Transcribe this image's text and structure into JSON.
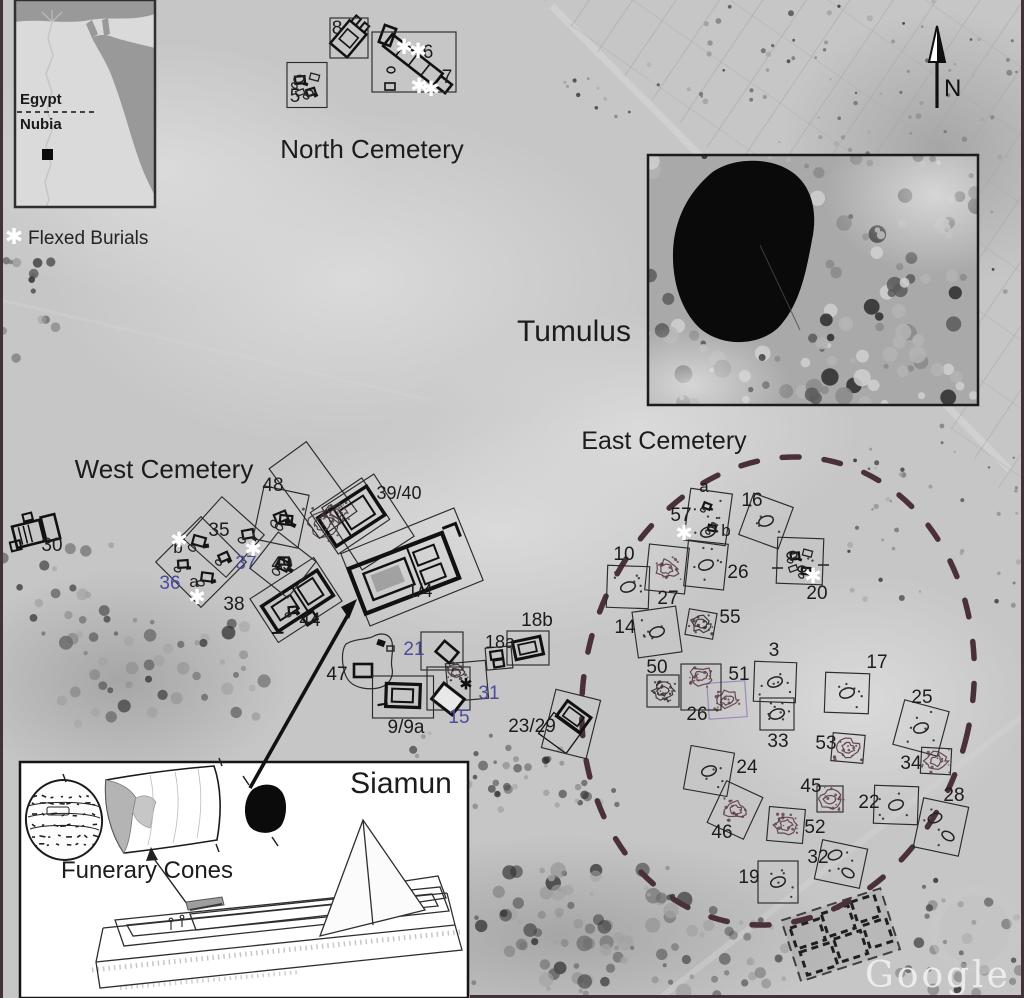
{
  "figure": {
    "legend": {
      "asterisk": "✱",
      "label": "Flexed Burials"
    },
    "inset_map": {
      "egypt": "Egypt",
      "nubia": "Nubia"
    },
    "compass": {
      "label": "N"
    },
    "titles": {
      "north_cemetery": "North Cemetery",
      "west_cemetery": "West Cemetery",
      "east_cemetery": "East Cemetery",
      "tumulus": "Tumulus"
    },
    "siamun": {
      "title": "Siamun",
      "caption": "Funerary Cones"
    },
    "watermark": "Google"
  },
  "colors": {
    "blue_label": "#4b4b9d",
    "maroon_dash": "#4a3038",
    "maroon_draw": "#5b3a47",
    "purple_box": "#9c86bb",
    "ink": "#1c1c1c",
    "white": "#ffffff"
  },
  "map_data": {
    "tombs": [
      {
        "label": "8",
        "lx": 337,
        "ly": 34,
        "box": [
          349,
          38,
          38,
          40,
          0
        ]
      },
      {
        "label": "5",
        "lx": 295,
        "ly": 102,
        "box": [
          307,
          85,
          40,
          45,
          0
        ],
        "glyph": "pebbles"
      },
      {
        "label": "6",
        "lx": 428,
        "ly": 58,
        "box": [
          414,
          62,
          84,
          60,
          0
        ]
      },
      {
        "label": "7",
        "lx": 447,
        "ly": 83
      },
      {
        "label": "30",
        "lx": 52,
        "ly": 551
      },
      {
        "label": "48",
        "lx": 273,
        "ly": 491,
        "box": [
          281,
          517,
          46,
          54,
          12
        ],
        "glyph": "cluster"
      },
      {
        "label": "35",
        "lx": 219,
        "ly": 536,
        "box": [
          224,
          537,
          57,
          57,
          42
        ]
      },
      {
        "label": "b",
        "lx": 178,
        "ly": 553,
        "fs": 17,
        "box": [
          201,
          562,
          64,
          64,
          45
        ]
      },
      {
        "label": "37",
        "lx": 246,
        "ly": 569,
        "color": "blue"
      },
      {
        "label": "49",
        "lx": 282,
        "ly": 570,
        "box": [
          283,
          565,
          48,
          46,
          38
        ],
        "glyph": "cluster"
      },
      {
        "label": "36",
        "lx": 170,
        "ly": 589,
        "color": "blue"
      },
      {
        "label": "a",
        "lx": 194,
        "ly": 587,
        "fs": 17
      },
      {
        "label": "38",
        "lx": 234,
        "ly": 610
      },
      {
        "label": "44",
        "lx": 310,
        "ly": 626
      },
      {
        "label": "39/40",
        "lx": 399,
        "ly": 499,
        "fs": 18
      },
      {
        "label": "1/4",
        "lx": 420,
        "ly": 597,
        "fs": 18
      },
      {
        "label": "47",
        "lx": 337,
        "ly": 680
      },
      {
        "label": "21",
        "lx": 414,
        "ly": 655,
        "color": "blue",
        "box": [
          442,
          651,
          42,
          38,
          0
        ]
      },
      {
        "label": "31",
        "lx": 489,
        "ly": 699,
        "color": "blue"
      },
      {
        "label": "15",
        "lx": 459,
        "ly": 723,
        "color": "blue"
      },
      {
        "label": "9/9a",
        "lx": 406,
        "ly": 733,
        "box": [
          403,
          697,
          61,
          42,
          0
        ]
      },
      {
        "label": "18a",
        "lx": 500,
        "ly": 648,
        "fs": 18,
        "box": [
          499,
          658,
          26,
          22,
          -5
        ]
      },
      {
        "label": "18b",
        "lx": 537,
        "ly": 626,
        "box": [
          528,
          648,
          42,
          34,
          0
        ]
      },
      {
        "label": "23/29",
        "lx": 532,
        "ly": 732,
        "box": [
          571,
          724,
          46,
          60,
          14
        ]
      },
      {
        "label": "a",
        "lx": 704,
        "ly": 492,
        "fs": 17
      },
      {
        "label": "57",
        "lx": 681,
        "ly": 521,
        "box": [
          708,
          517,
          42,
          52,
          8
        ],
        "glyph": "oval",
        "gy": 532,
        "dots": 12
      },
      {
        "label": "b",
        "lx": 726,
        "ly": 536,
        "fs": 17
      },
      {
        "label": "16",
        "lx": 752,
        "ly": 506,
        "box": [
          766,
          521,
          42,
          44,
          20
        ],
        "glyph": "oval",
        "dots": 5
      },
      {
        "label": "10",
        "lx": 624,
        "ly": 560,
        "box": [
          628,
          587,
          42,
          42,
          2
        ],
        "glyph": "oval",
        "dots": 7
      },
      {
        "label": "26",
        "lx": 738,
        "ly": 578,
        "box": [
          706,
          565,
          40,
          46,
          6
        ],
        "glyph": "oval",
        "dots": 6
      },
      {
        "label": "",
        "box": [
          667,
          569,
          40,
          46,
          6
        ],
        "glyph": "scribble"
      },
      {
        "label": "27",
        "lx": 668,
        "ly": 604
      },
      {
        "label": "20",
        "lx": 817,
        "ly": 599,
        "box": [
          800,
          561,
          46,
          46,
          2
        ],
        "glyph": "pebbles",
        "dots": 4
      },
      {
        "label": "14",
        "lx": 625,
        "ly": 633,
        "box": [
          657,
          632,
          44,
          46,
          -8
        ],
        "glyph": "oval",
        "dots": 6
      },
      {
        "label": "55",
        "lx": 730,
        "ly": 623,
        "box": [
          701,
          624,
          28,
          26,
          10
        ],
        "glyph": "scribdark"
      },
      {
        "label": "3",
        "lx": 774,
        "ly": 656,
        "box": [
          775,
          682,
          42,
          40,
          2
        ],
        "glyph": "oval",
        "dots": 7
      },
      {
        "label": "50",
        "lx": 657,
        "ly": 673,
        "box": [
          663,
          691,
          32,
          32,
          0
        ],
        "glyph": "scribdark",
        "dots": 10
      },
      {
        "label": "51",
        "lx": 739,
        "ly": 680,
        "box": [
          727,
          700,
          38,
          36,
          -4
        ],
        "boxColor": "purple",
        "glyph": "scribble"
      },
      {
        "label": "26",
        "lx": 697,
        "ly": 720,
        "box": [
          701,
          687,
          40,
          46,
          0
        ],
        "glyph": "scribble",
        "gy": 676
      },
      {
        "label": "17",
        "lx": 877,
        "ly": 668,
        "box": [
          847,
          693,
          44,
          40,
          2
        ],
        "glyph": "oval",
        "dots": 7
      },
      {
        "label": "33",
        "lx": 778,
        "ly": 747,
        "box": [
          777,
          714,
          34,
          32,
          0
        ],
        "glyph": "oval",
        "dots": 9
      },
      {
        "label": "25",
        "lx": 922,
        "ly": 703,
        "box": [
          921,
          728,
          46,
          46,
          15
        ],
        "glyph": "oval",
        "dots": 6
      },
      {
        "label": "53",
        "lx": 826,
        "ly": 749,
        "box": [
          848,
          748,
          32,
          28,
          5
        ],
        "glyph": "scribble"
      },
      {
        "label": "34",
        "lx": 911,
        "ly": 769,
        "box": [
          936,
          761,
          30,
          26,
          3
        ],
        "glyph": "scribble"
      },
      {
        "label": "24",
        "lx": 747,
        "ly": 773,
        "box": [
          709,
          771,
          44,
          44,
          10
        ],
        "glyph": "oval",
        "dots": 5
      },
      {
        "label": "45",
        "lx": 811,
        "ly": 792,
        "box": [
          830,
          799,
          26,
          26,
          0
        ],
        "glyph": "scribble"
      },
      {
        "label": "22",
        "lx": 869,
        "ly": 808,
        "box": [
          896,
          805,
          44,
          38,
          2
        ],
        "glyph": "oval",
        "dots": 5
      },
      {
        "label": "28",
        "lx": 954,
        "ly": 801,
        "box": [
          941,
          827,
          46,
          50,
          12
        ],
        "glyph": "oval2",
        "dots": 4
      },
      {
        "label": "46",
        "lx": 722,
        "ly": 838,
        "box": [
          735,
          810,
          40,
          46,
          25
        ],
        "glyph": "scribble"
      },
      {
        "label": "52",
        "lx": 815,
        "ly": 833,
        "box": [
          786,
          825,
          36,
          34,
          5
        ],
        "glyph": "scribble"
      },
      {
        "label": "32",
        "lx": 818,
        "ly": 863,
        "box": [
          841,
          864,
          46,
          40,
          12
        ],
        "glyph": "oval2",
        "dots": 4
      },
      {
        "label": "19",
        "lx": 749,
        "ly": 883,
        "box": [
          778,
          882,
          40,
          42,
          0
        ],
        "glyph": "oval",
        "dots": 6
      }
    ],
    "asterisks": [
      {
        "x": 404,
        "y": 47,
        "c": "white"
      },
      {
        "x": 418,
        "y": 51,
        "c": "white"
      },
      {
        "x": 419,
        "y": 86,
        "c": "white"
      },
      {
        "x": 431,
        "y": 89,
        "c": "white"
      },
      {
        "x": 179,
        "y": 540,
        "c": "white"
      },
      {
        "x": 253,
        "y": 549,
        "c": "white"
      },
      {
        "x": 197,
        "y": 597,
        "c": "white"
      },
      {
        "x": 684,
        "y": 533,
        "c": "white"
      },
      {
        "x": 813,
        "y": 576,
        "c": "white"
      },
      {
        "x": 466,
        "y": 684,
        "c": "black"
      }
    ]
  }
}
